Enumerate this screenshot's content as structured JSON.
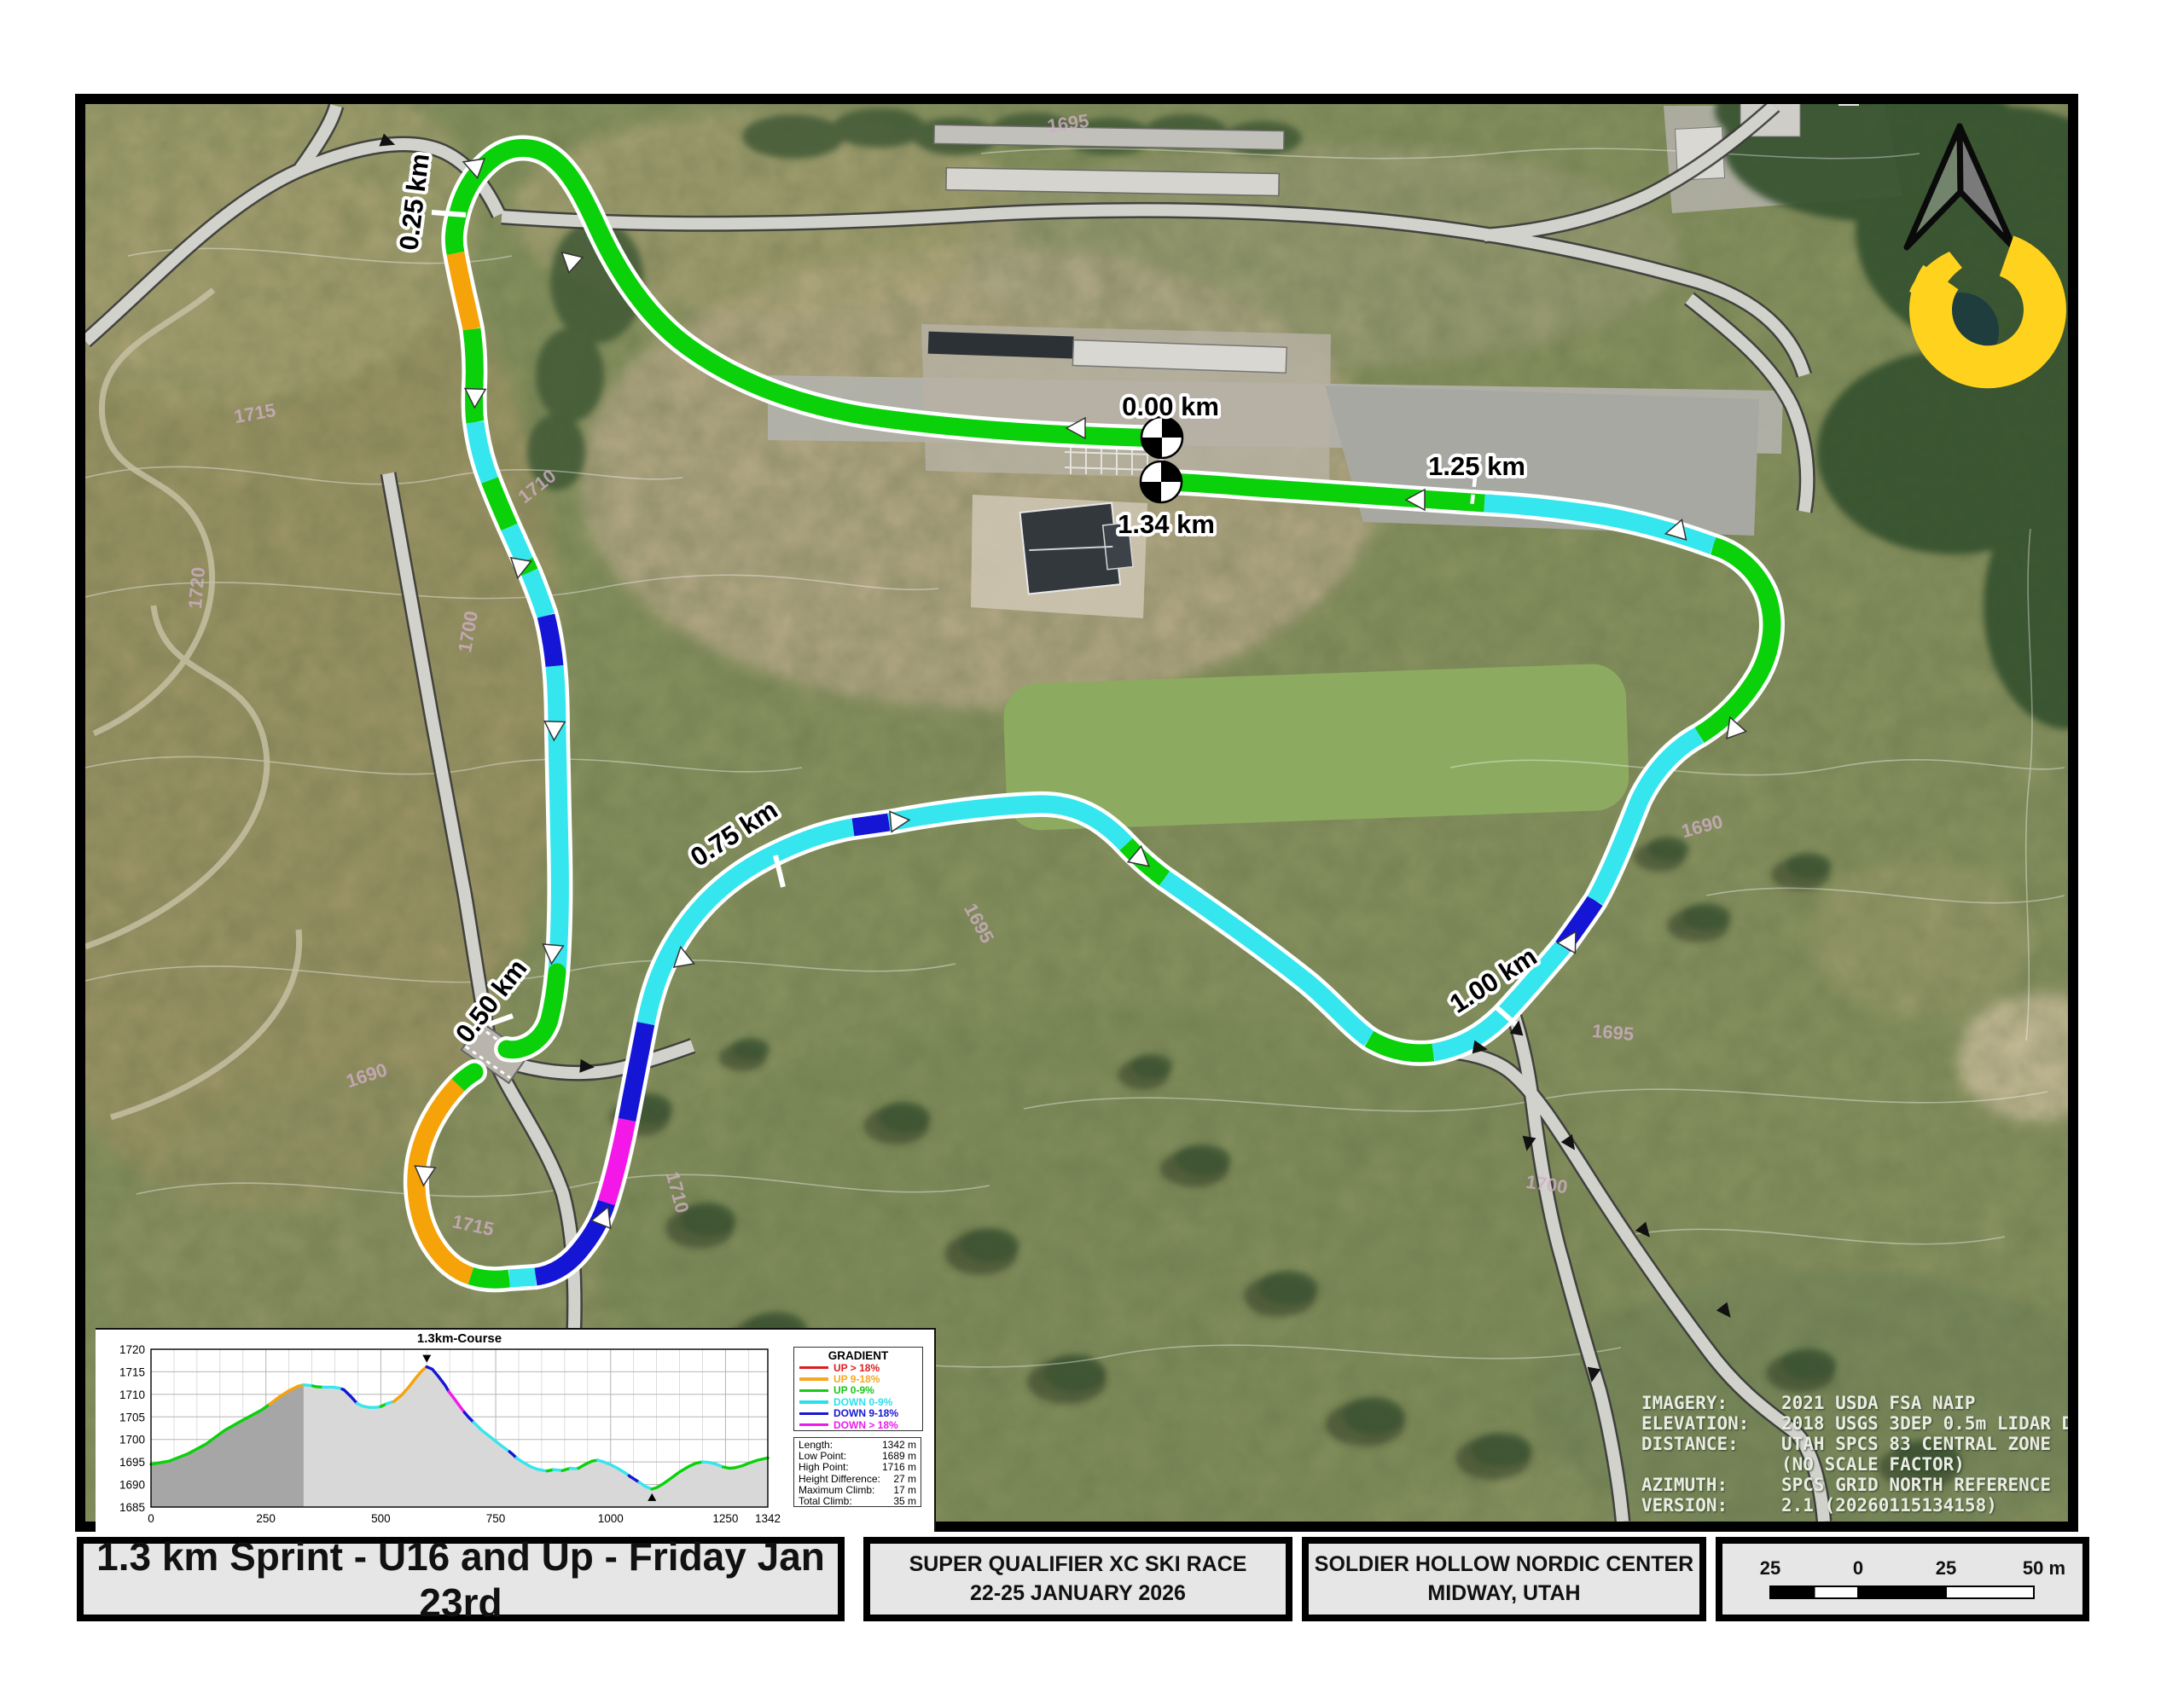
{
  "footer": {
    "box1": "1.3 km Sprint - U16 and Up - Friday Jan 23rd",
    "box2_line1": "SUPER QUALIFIER XC SKI RACE",
    "box2_line2": "22-25 JANUARY 2026",
    "box3_line1": "SOLDIER HOLLOW NORDIC CENTER",
    "box3_line2": "MIDWAY, UTAH"
  },
  "scalebar": {
    "labels": [
      "25",
      "0",
      "25",
      "50 m"
    ]
  },
  "info": {
    "lines": [
      {
        "label": "IMAGERY:",
        "value": "2021 USDA FSA NAIP"
      },
      {
        "label": "ELEVATION:",
        "value": "2018 USGS 3DEP 0.5m LIDAR DEM"
      },
      {
        "label": "DISTANCE:",
        "value": "UTAH SPCS 83 CENTRAL ZONE"
      },
      {
        "label": "",
        "value": "(NO SCALE FACTOR)"
      },
      {
        "label": "AZIMUTH:",
        "value": "SPCS GRID NORTH REFERENCE"
      },
      {
        "label": "VERSION:",
        "value": "2.1 (20260115134158)"
      }
    ]
  },
  "palette": {
    "up3": "#dd1d1d",
    "up2": "#f5a309",
    "up1": "#0ad10a",
    "down1": "#35e6ef",
    "down2": "#1515d6",
    "down3": "#f318e8"
  },
  "map": {
    "distance_labels": [
      {
        "label": "0.00 km",
        "x": 1372,
        "y": 487,
        "rot": 0
      },
      {
        "label": "1.34 km",
        "x": 1367,
        "y": 625,
        "rot": 0
      },
      {
        "label": "1.25 km",
        "x": 1731,
        "y": 557,
        "rot": 0
      },
      {
        "label": "0.25 km",
        "x": 496,
        "y": 238,
        "rot": -83
      },
      {
        "label": "0.50 km",
        "x": 584,
        "y": 1180,
        "rot": -52
      },
      {
        "label": "0.75 km",
        "x": 866,
        "y": 986,
        "rot": -33
      },
      {
        "label": "1.00 km",
        "x": 1756,
        "y": 1158,
        "rot": -33
      }
    ],
    "contour_labels": [
      {
        "t": "1695",
        "x": 1253,
        "y": 152,
        "r": -8
      },
      {
        "t": "1695",
        "x": 1141,
        "y": 1086,
        "r": 62
      },
      {
        "t": "1690",
        "x": 1997,
        "y": 976,
        "r": -15
      },
      {
        "t": "1695",
        "x": 1890,
        "y": 1218,
        "r": 5
      },
      {
        "t": "1700",
        "x": 1812,
        "y": 1396,
        "r": 8
      },
      {
        "t": "1710",
        "x": 634,
        "y": 576,
        "r": -38
      },
      {
        "t": "1700",
        "x": 556,
        "y": 742,
        "r": -80
      },
      {
        "t": "1715",
        "x": 553,
        "y": 1444,
        "r": 12
      },
      {
        "t": "1710",
        "x": 787,
        "y": 1400,
        "r": 75
      },
      {
        "t": "1720",
        "x": 238,
        "y": 690,
        "r": -85
      },
      {
        "t": "1715",
        "x": 300,
        "y": 492,
        "r": -10
      },
      {
        "t": "1690",
        "x": 432,
        "y": 1268,
        "r": -18
      }
    ],
    "course_arrows": [
      [
        1268,
        502,
        180
      ],
      [
        672,
        308,
        222
      ],
      [
        560,
        196,
        200
      ],
      [
        557,
        460,
        92
      ],
      [
        610,
        660,
        100
      ],
      [
        650,
        850,
        92
      ],
      [
        648,
        1112,
        95
      ],
      [
        498,
        1372,
        95
      ],
      [
        706,
        1432,
        292
      ],
      [
        801,
        1128,
        260
      ],
      [
        1048,
        963,
        355
      ],
      [
        1333,
        1004,
        40
      ],
      [
        1838,
        1108,
        300
      ],
      [
        2034,
        858,
        250
      ],
      [
        1970,
        622,
        168
      ],
      [
        1666,
        586,
        180
      ]
    ],
    "trail_arrows": [
      [
        450,
        165,
        20
      ],
      [
        683,
        1250,
        5
      ],
      [
        1730,
        1228,
        10
      ],
      [
        1838,
        1337,
        55
      ],
      [
        1925,
        1440,
        50
      ],
      [
        2020,
        1534,
        52
      ],
      [
        1792,
        1336,
        100
      ],
      [
        1868,
        1607,
        100
      ],
      [
        1778,
        1210,
        280
      ]
    ],
    "ticks": [
      [
        506,
        249,
        546,
        252
      ],
      [
        573,
        1201,
        601,
        1191
      ],
      [
        909,
        1003,
        918,
        1040
      ],
      [
        1754,
        1181,
        1779,
        1203
      ]
    ],
    "leaders": [
      [
        1362,
        478,
        1361,
        592
      ],
      [
        1729,
        560,
        1724,
        604
      ]
    ],
    "start_finish_markers": [
      [
        1362,
        513
      ],
      [
        1361,
        565
      ]
    ]
  },
  "chart_data": {
    "type": "line",
    "title": "1.3km-Course",
    "xlabel": "",
    "ylabel": "",
    "xlim": [
      0,
      1342
    ],
    "ylim": [
      1685,
      1720
    ],
    "x_ticks": [
      0,
      250,
      500,
      750,
      1000,
      1250,
      1342
    ],
    "y_ticks": [
      1685,
      1690,
      1695,
      1700,
      1705,
      1710,
      1715,
      1720
    ],
    "grid": true,
    "legend_title": "GRADIENT",
    "legend": [
      {
        "key": "up3",
        "label": "UP > 18%",
        "color": "#dd1d1d"
      },
      {
        "key": "up2",
        "label": "UP 9-18%",
        "color": "#f5a825"
      },
      {
        "key": "up1",
        "label": "UP 0-9%",
        "color": "#19c819"
      },
      {
        "key": "down1",
        "label": "DOWN 0-9%",
        "color": "#2ee0ea"
      },
      {
        "key": "down2",
        "label": "DOWN 9-18%",
        "color": "#1717cf"
      },
      {
        "key": "down3",
        "label": "DOWN > 18%",
        "color": "#ec1bec"
      }
    ],
    "stats": [
      {
        "label": "Length:",
        "value": "1342 m"
      },
      {
        "label": "Low Point:",
        "value": "1689 m"
      },
      {
        "label": "High Point:",
        "value": "1716 m"
      },
      {
        "label": "Height Difference:",
        "value": "27 m"
      },
      {
        "label": "Maximum Climb:",
        "value": "17 m"
      },
      {
        "label": "Total Climb:",
        "value": "35 m"
      }
    ],
    "high_point_m": 600,
    "low_point_m": 1090,
    "dark_fill_until_m": 332,
    "profile": [
      [
        0,
        1694.5
      ],
      [
        40,
        1695.2
      ],
      [
        80,
        1696.8
      ],
      [
        120,
        1699
      ],
      [
        160,
        1702
      ],
      [
        200,
        1704.3
      ],
      [
        240,
        1706.5
      ],
      [
        258,
        1707.8
      ],
      [
        280,
        1709.5
      ],
      [
        300,
        1710.8
      ],
      [
        320,
        1711.8
      ],
      [
        332,
        1712.1
      ],
      [
        345,
        1712
      ],
      [
        360,
        1711.7
      ],
      [
        375,
        1711.6
      ],
      [
        395,
        1711.6
      ],
      [
        410,
        1711.4
      ],
      [
        420,
        1711
      ],
      [
        435,
        1709.5
      ],
      [
        448,
        1708
      ],
      [
        460,
        1707.4
      ],
      [
        475,
        1707.1
      ],
      [
        490,
        1707.1
      ],
      [
        500,
        1707.3
      ],
      [
        512,
        1707.9
      ],
      [
        528,
        1708.4
      ],
      [
        545,
        1709.8
      ],
      [
        560,
        1711.5
      ],
      [
        575,
        1713.5
      ],
      [
        590,
        1715.3
      ],
      [
        600,
        1716.1
      ],
      [
        612,
        1715.6
      ],
      [
        625,
        1714
      ],
      [
        640,
        1712
      ],
      [
        648,
        1710.6
      ],
      [
        660,
        1709
      ],
      [
        670,
        1707.6
      ],
      [
        682,
        1706
      ],
      [
        692,
        1704.8
      ],
      [
        702,
        1703.8
      ],
      [
        720,
        1702
      ],
      [
        740,
        1700.4
      ],
      [
        760,
        1698.8
      ],
      [
        780,
        1697.3
      ],
      [
        788,
        1696.6
      ],
      [
        795,
        1695.9
      ],
      [
        810,
        1694.9
      ],
      [
        825,
        1694
      ],
      [
        840,
        1693.4
      ],
      [
        855,
        1693.1
      ],
      [
        862,
        1693
      ],
      [
        876,
        1693.3
      ],
      [
        886,
        1693.2
      ],
      [
        895,
        1693.1
      ],
      [
        905,
        1693.4
      ],
      [
        912,
        1693.6
      ],
      [
        922,
        1693.5
      ],
      [
        930,
        1693.6
      ],
      [
        945,
        1694.5
      ],
      [
        960,
        1695.2
      ],
      [
        972,
        1695.4
      ],
      [
        985,
        1695
      ],
      [
        1000,
        1694.4
      ],
      [
        1015,
        1693.6
      ],
      [
        1030,
        1692.7
      ],
      [
        1045,
        1691.6
      ],
      [
        1062,
        1690.5
      ],
      [
        1075,
        1689.6
      ],
      [
        1090,
        1689
      ],
      [
        1100,
        1689.3
      ],
      [
        1115,
        1690.2
      ],
      [
        1130,
        1691.3
      ],
      [
        1150,
        1692.8
      ],
      [
        1170,
        1694
      ],
      [
        1185,
        1694.7
      ],
      [
        1200,
        1695
      ],
      [
        1215,
        1694.9
      ],
      [
        1230,
        1694.5
      ],
      [
        1245,
        1693.9
      ],
      [
        1258,
        1693.6
      ],
      [
        1270,
        1693.7
      ],
      [
        1285,
        1694.1
      ],
      [
        1300,
        1694.7
      ],
      [
        1320,
        1695.4
      ],
      [
        1342,
        1695.9
      ]
    ],
    "segments": [
      [
        0,
        258,
        "up1"
      ],
      [
        258,
        332,
        "up2"
      ],
      [
        332,
        352,
        "down1"
      ],
      [
        352,
        374,
        "up1"
      ],
      [
        374,
        416,
        "down1"
      ],
      [
        416,
        448,
        "down2"
      ],
      [
        448,
        500,
        "down1"
      ],
      [
        500,
        512,
        "up1"
      ],
      [
        512,
        528,
        "down1"
      ],
      [
        528,
        600,
        "up2"
      ],
      [
        600,
        648,
        "down2"
      ],
      [
        648,
        682,
        "down3"
      ],
      [
        682,
        702,
        "down2"
      ],
      [
        702,
        780,
        "down1"
      ],
      [
        780,
        795,
        "down2"
      ],
      [
        795,
        862,
        "down1"
      ],
      [
        862,
        876,
        "up1"
      ],
      [
        876,
        895,
        "down1"
      ],
      [
        895,
        912,
        "up1"
      ],
      [
        912,
        930,
        "down1"
      ],
      [
        930,
        972,
        "up1"
      ],
      [
        972,
        1040,
        "down1"
      ],
      [
        1040,
        1062,
        "down2"
      ],
      [
        1062,
        1090,
        "down1"
      ],
      [
        1090,
        1200,
        "up1"
      ],
      [
        1200,
        1245,
        "down1"
      ],
      [
        1245,
        1342,
        "up1"
      ]
    ]
  }
}
